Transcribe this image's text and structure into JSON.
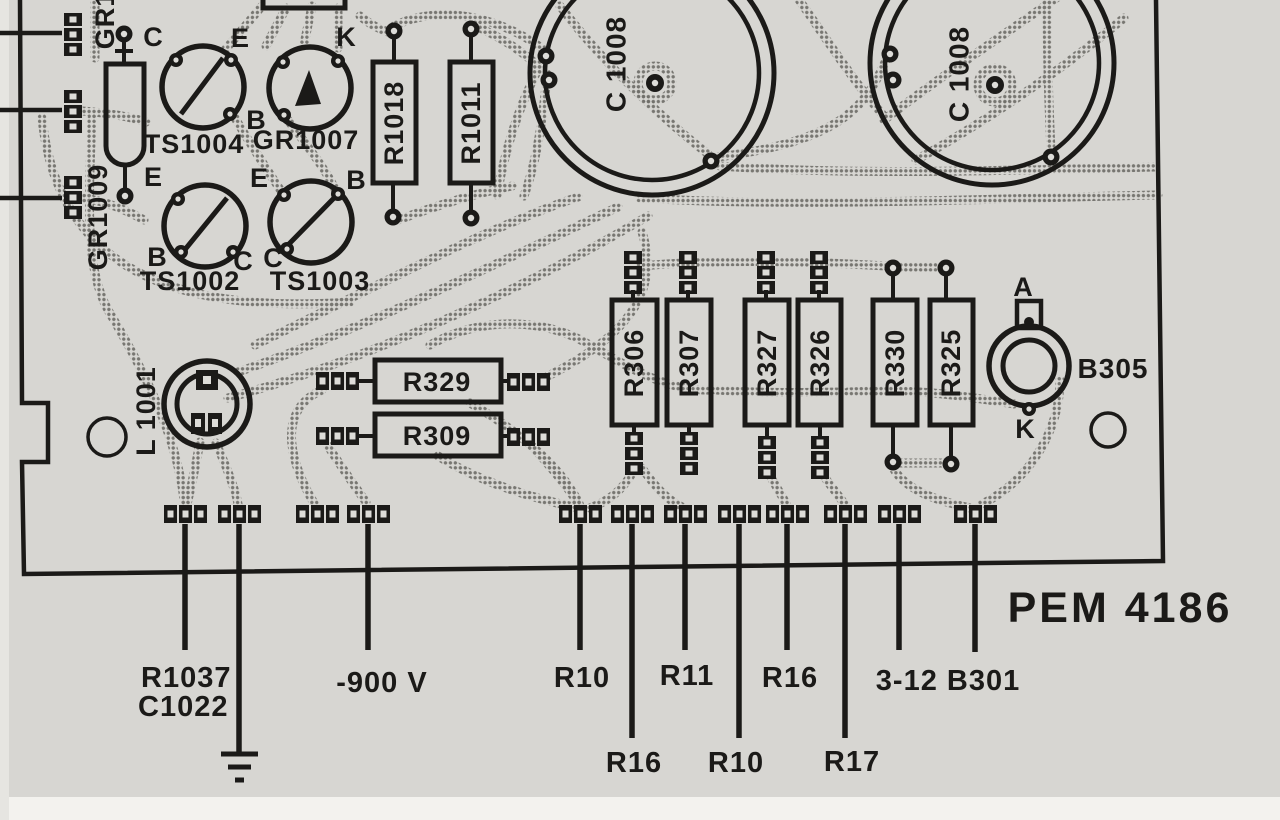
{
  "colors": {
    "ink": "#1b1a18",
    "paper": "#d7d6d2",
    "trace_dot": "#6f6e69"
  },
  "board": {
    "part_number": "PEM 4186"
  },
  "components": {
    "gr_top_partial": "GR1",
    "gr1009": "GR1009",
    "ts1004": "TS1004",
    "gr1007": "GR1007",
    "ts1002": "TS1002",
    "ts1003": "TS1003",
    "r1018": "R1018",
    "r1011": "R1011",
    "c1008_left": "C 1008",
    "c1008_right": "C 1008",
    "l1001": "L 1001",
    "r329": "R329",
    "r309": "R309",
    "r306": "R306",
    "r307": "R307",
    "r327": "R327",
    "r326": "R326",
    "r330": "R330",
    "r325": "R325",
    "b305": "B305"
  },
  "pin_labels": {
    "ts1004_c": "C",
    "ts1004_e": "E",
    "ts1004_b": "B",
    "gr1007_k": "K",
    "ts1002_e": "E",
    "ts1002_b": "B",
    "ts1002_c": "C",
    "ts1003_e": "E",
    "ts1003_b": "B",
    "ts1003_c": "C",
    "b305_a": "A",
    "b305_k": "K"
  },
  "callouts": {
    "r1037": "R1037",
    "c1022": "C1022",
    "minus_900v": "-900 V",
    "r10_a": "R10",
    "r11": "R11",
    "r16_a": "R16",
    "b301": "3-12 B301",
    "r16_b": "R16",
    "r10_b": "R10",
    "r17": "R17"
  }
}
